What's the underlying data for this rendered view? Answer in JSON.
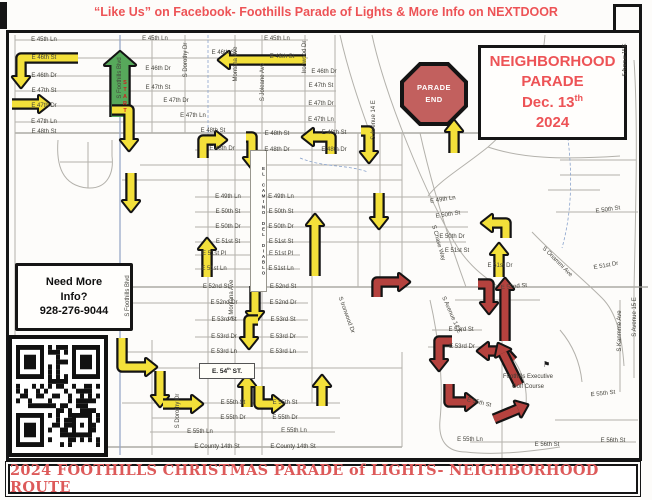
{
  "header": {
    "text": "“Like Us” on Facebook- Foothills Parade of Lights & More Info on NEXTDOOR"
  },
  "footer": {
    "text": "2024 FOOTHILLS CHRISTMAS PARADE of LIGHTS- NEIGHBORHOOD ROUTE"
  },
  "parade_box": {
    "line1": "NEIGHBORHOOD",
    "line2": "PARADE",
    "date_pre": "Dec. 13",
    "date_sup": "th",
    "year": "2024"
  },
  "parade_end": {
    "line1": "PARADE",
    "line2": "END"
  },
  "info_box": {
    "line1": "Need More",
    "line2": "Info?",
    "line3": "928-276-9044"
  },
  "start_label": "START",
  "e54_box": {
    "pre": "E. 54",
    "sup": "th",
    "post": " ST."
  },
  "golf": {
    "line1": "Foothills Executive",
    "line2": "Golf Course",
    "flag_glyph": "⚑"
  },
  "map": {
    "el_camino": "EL CAMINO DEL DIABLO",
    "colors": {
      "route_yellow": "#f3e03a",
      "route_green": "#57a95b",
      "route_red": "#b5423e",
      "sign_red": "#c2605e",
      "text_red": "#ed5356",
      "banner_red": "#dd5a5a"
    },
    "street_labels": [
      {
        "t": "E 45th Ln",
        "x": 44,
        "y": 40
      },
      {
        "t": "E 46th St",
        "x": 44,
        "y": 58
      },
      {
        "t": "E 46th Dr",
        "x": 44,
        "y": 76
      },
      {
        "t": "E 47th St",
        "x": 44,
        "y": 91
      },
      {
        "t": "E 47th Dr",
        "x": 44,
        "y": 106
      },
      {
        "t": "E 47th Ln",
        "x": 44,
        "y": 122
      },
      {
        "t": "E 48th St",
        "x": 44,
        "y": 132
      },
      {
        "t": "E 45th Ln",
        "x": 155,
        "y": 39
      },
      {
        "t": "E 46th St",
        "x": 224,
        "y": 53
      },
      {
        "t": "E 46th Dr",
        "x": 158,
        "y": 69
      },
      {
        "t": "E 47th St",
        "x": 158,
        "y": 88
      },
      {
        "t": "E 47th Dr",
        "x": 176,
        "y": 101
      },
      {
        "t": "E 47th Ln",
        "x": 193,
        "y": 116
      },
      {
        "t": "E 48th St",
        "x": 213,
        "y": 131
      },
      {
        "t": "E 48th Dr",
        "x": 222,
        "y": 149
      },
      {
        "t": "E 45th Ln",
        "x": 277,
        "y": 39
      },
      {
        "t": "E 46th St",
        "x": 282,
        "y": 57
      },
      {
        "t": "E 48th St",
        "x": 277,
        "y": 134
      },
      {
        "t": "E 48th Dr",
        "x": 277,
        "y": 150
      },
      {
        "t": "E 46th Dr",
        "x": 324,
        "y": 72
      },
      {
        "t": "E 47th St",
        "x": 321,
        "y": 86
      },
      {
        "t": "E 47th Dr",
        "x": 321,
        "y": 104
      },
      {
        "t": "E 47th Ln",
        "x": 321,
        "y": 120
      },
      {
        "t": "E 48th St",
        "x": 334,
        "y": 133
      },
      {
        "t": "E 48th Dr",
        "x": 334,
        "y": 150
      },
      {
        "t": "E 49th Ln",
        "x": 228,
        "y": 197
      },
      {
        "t": "E 50th St",
        "x": 228,
        "y": 212
      },
      {
        "t": "E 50th Dr",
        "x": 228,
        "y": 227
      },
      {
        "t": "E 51st St",
        "x": 228,
        "y": 242
      },
      {
        "t": "E 51st Pl",
        "x": 214,
        "y": 254
      },
      {
        "t": "E 51st Ln",
        "x": 214,
        "y": 269
      },
      {
        "t": "E 52nd St",
        "x": 216,
        "y": 287
      },
      {
        "t": "E 52nd Dr",
        "x": 224,
        "y": 303
      },
      {
        "t": "E 53rd St",
        "x": 224,
        "y": 320
      },
      {
        "t": "E 53rd Dr",
        "x": 224,
        "y": 337
      },
      {
        "t": "E 53rd Ln",
        "x": 224,
        "y": 352
      },
      {
        "t": "E 49th Ln",
        "x": 281,
        "y": 197
      },
      {
        "t": "E 50th St",
        "x": 281,
        "y": 212
      },
      {
        "t": "E 50th Dr",
        "x": 281,
        "y": 227
      },
      {
        "t": "E 51st St",
        "x": 281,
        "y": 242
      },
      {
        "t": "E 51st Pl",
        "x": 281,
        "y": 254
      },
      {
        "t": "E 51st Ln",
        "x": 281,
        "y": 269
      },
      {
        "t": "E 52nd St",
        "x": 283,
        "y": 287
      },
      {
        "t": "E 52nd Dr",
        "x": 283,
        "y": 303
      },
      {
        "t": "E 53rd St",
        "x": 283,
        "y": 320
      },
      {
        "t": "E 53rd Dr",
        "x": 283,
        "y": 337
      },
      {
        "t": "E 53rd Ln",
        "x": 283,
        "y": 352
      },
      {
        "t": "E 49th Ln",
        "x": 443,
        "y": 200,
        "r": -8
      },
      {
        "t": "E 50th St",
        "x": 448,
        "y": 215,
        "r": -8
      },
      {
        "t": "E 50th Dr",
        "x": 452,
        "y": 237
      },
      {
        "t": "E 51st St",
        "x": 457,
        "y": 251
      },
      {
        "t": "E 51st Dr",
        "x": 500,
        "y": 266
      },
      {
        "t": "E 52nd St",
        "x": 514,
        "y": 287,
        "r": -5
      },
      {
        "t": "E 53rd St",
        "x": 461,
        "y": 330
      },
      {
        "t": "E 53rd Dr",
        "x": 462,
        "y": 347
      },
      {
        "t": "E 50th St",
        "x": 608,
        "y": 210,
        "r": -8
      },
      {
        "t": "E 51st Dr",
        "x": 606,
        "y": 266,
        "r": -10
      },
      {
        "t": "E 55th St",
        "x": 233,
        "y": 403
      },
      {
        "t": "E 55th Dr",
        "x": 233,
        "y": 418
      },
      {
        "t": "E 55th Ln",
        "x": 200,
        "y": 432
      },
      {
        "t": "E County 14th St",
        "x": 217,
        "y": 447
      },
      {
        "t": "E 55th St",
        "x": 285,
        "y": 403
      },
      {
        "t": "E 55th Dr",
        "x": 285,
        "y": 418
      },
      {
        "t": "E 55th Ln",
        "x": 294,
        "y": 431
      },
      {
        "t": "E County 14th St",
        "x": 293,
        "y": 447
      },
      {
        "t": "E 55th St",
        "x": 479,
        "y": 403,
        "r": 14
      },
      {
        "t": "E 55th Ln",
        "x": 470,
        "y": 440
      },
      {
        "t": "E 56th St",
        "x": 547,
        "y": 445
      },
      {
        "t": "E 56th St",
        "x": 613,
        "y": 441
      },
      {
        "t": "E 55th St",
        "x": 603,
        "y": 394,
        "r": -6
      },
      {
        "t": "S Foothills Blvd",
        "x": 120,
        "y": 78,
        "r": -90
      },
      {
        "t": "S Dorothy Dr",
        "x": 186,
        "y": 60,
        "r": -90
      },
      {
        "t": "Montana Ave",
        "x": 236,
        "y": 64,
        "r": -90
      },
      {
        "t": "S Joleane Ave",
        "x": 263,
        "y": 82,
        "r": -90
      },
      {
        "t": "Ironwood Dr",
        "x": 305,
        "y": 57,
        "r": -90
      },
      {
        "t": "S Avenue 14 E",
        "x": 374,
        "y": 120,
        "r": -90
      },
      {
        "t": "S Foothills Blvd",
        "x": 128,
        "y": 296,
        "r": -90
      },
      {
        "t": "S Montana Ave",
        "x": 232,
        "y": 300,
        "r": -90
      },
      {
        "t": "S Dorothy Dr",
        "x": 178,
        "y": 411,
        "r": -90
      },
      {
        "t": "S Kanmme Ave",
        "x": 620,
        "y": 331,
        "r": -90
      },
      {
        "t": "S Avenue 15 E",
        "x": 635,
        "y": 317,
        "r": -90
      },
      {
        "t": "S Avenue 15 E",
        "x": 625,
        "y": 60,
        "r": -90,
        "s": 5
      },
      {
        "t": "S Ironwood Dr",
        "x": 346,
        "y": 315,
        "r": 70
      },
      {
        "t": "S Avenue 14 E",
        "x": 451,
        "y": 315,
        "r": 66
      },
      {
        "t": "S Chase Way",
        "x": 438,
        "y": 243,
        "r": 74
      },
      {
        "t": "S Onammi Ave",
        "x": 557,
        "y": 262,
        "r": 45
      }
    ],
    "arrows": [
      {
        "p": [
          [
            78,
            58
          ],
          [
            21,
            58
          ],
          [
            21,
            77
          ]
        ],
        "c": "y"
      },
      {
        "p": [
          [
            306,
            60
          ],
          [
            229,
            60
          ]
        ],
        "c": "y"
      },
      {
        "p": [
          [
            12,
            104
          ],
          [
            39,
            104
          ]
        ],
        "c": "y"
      },
      {
        "p": [
          [
            120,
            117
          ],
          [
            120,
            65
          ]
        ],
        "c": "g",
        "w": 17
      },
      {
        "p": [
          [
            112,
            110
          ],
          [
            129,
            110
          ],
          [
            129,
            140
          ]
        ],
        "c": "y"
      },
      {
        "p": [
          [
            131,
            173
          ],
          [
            131,
            201
          ]
        ],
        "c": "y"
      },
      {
        "p": [
          [
            203,
            158
          ],
          [
            203,
            140
          ],
          [
            216,
            140
          ]
        ],
        "c": "y"
      },
      {
        "p": [
          [
            246,
            137
          ],
          [
            252,
            137
          ],
          [
            252,
            158
          ]
        ],
        "c": "y"
      },
      {
        "p": [
          [
            331,
            154
          ],
          [
            331,
            137
          ],
          [
            313,
            137
          ]
        ],
        "c": "y"
      },
      {
        "p": [
          [
            361,
            131
          ],
          [
            369,
            131
          ],
          [
            369,
            152
          ]
        ],
        "c": "y"
      },
      {
        "p": [
          [
            454,
            153
          ],
          [
            454,
            131
          ]
        ],
        "c": "y"
      },
      {
        "p": [
          [
            379,
            193
          ],
          [
            379,
            218
          ]
        ],
        "c": "y"
      },
      {
        "p": [
          [
            315,
            276
          ],
          [
            315,
            225
          ]
        ],
        "c": "y"
      },
      {
        "p": [
          [
            207,
            277
          ],
          [
            207,
            249
          ]
        ],
        "c": "y"
      },
      {
        "p": [
          [
            255,
            286
          ],
          [
            255,
            312
          ]
        ],
        "c": "y"
      },
      {
        "p": [
          [
            258,
            320
          ],
          [
            249,
            320
          ],
          [
            249,
            338
          ]
        ],
        "c": "y"
      },
      {
        "p": [
          [
            122,
            338
          ],
          [
            122,
            367
          ],
          [
            146,
            367
          ]
        ],
        "c": "y"
      },
      {
        "p": [
          [
            160,
            371
          ],
          [
            160,
            396
          ]
        ],
        "c": "y"
      },
      {
        "p": [
          [
            163,
            404
          ],
          [
            192,
            404
          ]
        ],
        "c": "y"
      },
      {
        "p": [
          [
            247,
            407
          ],
          [
            247,
            386
          ]
        ],
        "c": "y"
      },
      {
        "p": [
          [
            259,
            386
          ],
          [
            259,
            404
          ],
          [
            273,
            404
          ]
        ],
        "c": "y"
      },
      {
        "p": [
          [
            322,
            406
          ],
          [
            322,
            386
          ]
        ],
        "c": "y"
      },
      {
        "p": [
          [
            506,
            238
          ],
          [
            506,
            223
          ],
          [
            492,
            223
          ]
        ],
        "c": "y"
      },
      {
        "p": [
          [
            499,
            277
          ],
          [
            499,
            254
          ]
        ],
        "c": "y"
      },
      {
        "p": [
          [
            377,
            297
          ],
          [
            377,
            282
          ],
          [
            399,
            282
          ]
        ],
        "c": "r"
      },
      {
        "p": [
          [
            478,
            284
          ],
          [
            489,
            284
          ],
          [
            489,
            303
          ]
        ],
        "c": "r"
      },
      {
        "p": [
          [
            505,
            341
          ],
          [
            505,
            289
          ]
        ],
        "c": "r"
      },
      {
        "p": [
          [
            513,
            361
          ],
          [
            504,
            351
          ],
          [
            488,
            351
          ]
        ],
        "c": "r"
      },
      {
        "p": [
          [
            519,
            385
          ],
          [
            503,
            353
          ]
        ],
        "c": "r"
      },
      {
        "p": [
          [
            452,
            341
          ],
          [
            439,
            341
          ],
          [
            439,
            360
          ]
        ],
        "c": "r"
      },
      {
        "p": [
          [
            449,
            384
          ],
          [
            449,
            402
          ],
          [
            466,
            402
          ]
        ],
        "c": "r"
      },
      {
        "p": [
          [
            494,
            419
          ],
          [
            518,
            409
          ]
        ],
        "c": "r"
      }
    ]
  }
}
